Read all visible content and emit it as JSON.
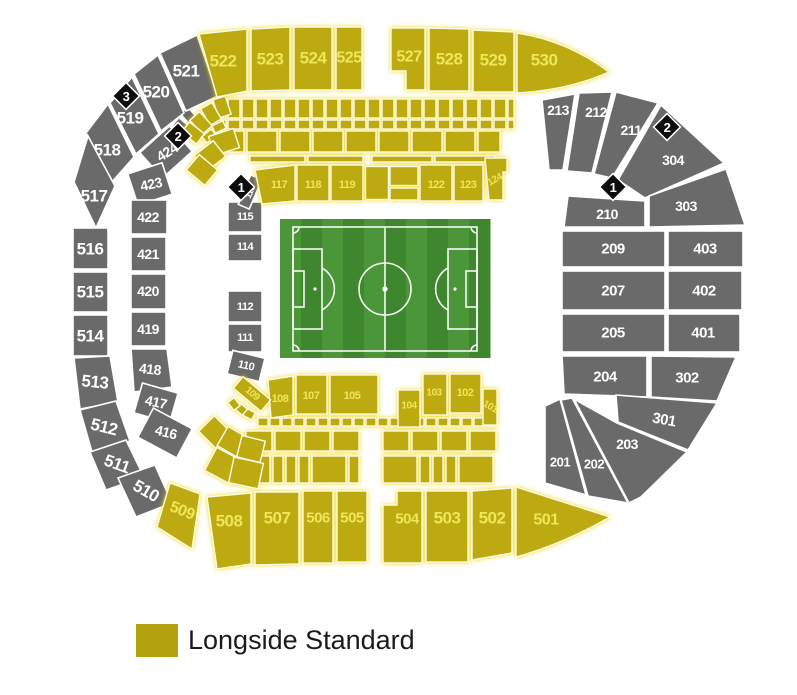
{
  "legend": {
    "label": "Longside Standard",
    "swatch_color": "#B3A20D"
  },
  "colors": {
    "standard_fill": "#BCAA10",
    "standard_text": "#EFE65A",
    "unavailable_fill": "#6A6A6A",
    "unavailable_text": "#FFFFFF",
    "landmark_fill": "#0D0D0D",
    "landmark_text": "#FFFFFF",
    "pitch_stripe_light": "#4A9638",
    "pitch_stripe_dark": "#3F872E",
    "pitch_line": "#FFFFFF",
    "background": "#FFFFFF"
  },
  "landmarks": [
    {
      "label": "3",
      "x": 126,
      "y": 96
    },
    {
      "label": "2",
      "x": 178,
      "y": 136
    },
    {
      "label": "1",
      "x": 241,
      "y": 187
    },
    {
      "label": "2",
      "x": 667,
      "y": 127
    },
    {
      "label": "1",
      "x": 613,
      "y": 187
    }
  ],
  "sections": [
    {
      "id": "522",
      "kind": "standard",
      "shape": "poly",
      "pts": "199,34 247,29 247,91 217,97",
      "lx": 223,
      "ly": 61,
      "fs": 17
    },
    {
      "id": "523",
      "kind": "standard",
      "shape": "poly",
      "pts": "251,29 290,27 290,90 251,91",
      "lx": 270,
      "ly": 59,
      "fs": 17
    },
    {
      "id": "524",
      "kind": "standard",
      "shape": "poly",
      "pts": "294,27 332,27 332,90 294,90",
      "lx": 313,
      "ly": 58,
      "fs": 17
    },
    {
      "id": "525",
      "kind": "standard",
      "shape": "poly",
      "pts": "336,27 362,27 362,90 336,90",
      "lx": 349,
      "ly": 58,
      "fs": 16
    },
    {
      "id": "527",
      "kind": "standard",
      "shape": "poly",
      "pts": "391,28 425,28 425,90 406,90 406,71 391,71",
      "lx": 409,
      "ly": 57,
      "fs": 16
    },
    {
      "id": "528",
      "kind": "standard",
      "shape": "poly",
      "pts": "429,28 469,29 469,91 429,91",
      "lx": 449,
      "ly": 59,
      "fs": 17
    },
    {
      "id": "529",
      "kind": "standard",
      "shape": "poly",
      "pts": "473,30 514,32 514,92 473,92",
      "lx": 493,
      "ly": 60,
      "fs": 17
    },
    {
      "id": "530",
      "kind": "standard",
      "shape": "path",
      "d": "M517,33 C552,38 584,53 609,72 C578,86 547,91 517,93 Z",
      "lx": 544,
      "ly": 60,
      "fs": 17
    },
    {
      "id": "509",
      "kind": "standard",
      "shape": "poly",
      "pts": "170,483 200,494 192,549 157,527",
      "lx": 182,
      "ly": 511,
      "fs": 16,
      "lr": 22
    },
    {
      "id": "508",
      "kind": "standard",
      "shape": "poly",
      "pts": "207,497 251,493 251,564 217,569",
      "lx": 229,
      "ly": 521,
      "fs": 17
    },
    {
      "id": "507",
      "kind": "standard",
      "shape": "poly",
      "pts": "255,492 299,492 299,564 255,565",
      "lx": 277,
      "ly": 518,
      "fs": 17
    },
    {
      "id": "506",
      "kind": "standard",
      "shape": "rect",
      "x": 303,
      "y": 491,
      "w": 30,
      "h": 72,
      "lx": 318,
      "ly": 518,
      "fs": 15
    },
    {
      "id": "505",
      "kind": "standard",
      "shape": "rect",
      "x": 337,
      "y": 491,
      "w": 30,
      "h": 71,
      "lx": 352,
      "ly": 518,
      "fs": 15
    },
    {
      "id": "504",
      "kind": "standard",
      "shape": "poly",
      "pts": "383,505 397,505 397,491 422,491 422,563 383,563",
      "lx": 407,
      "ly": 519,
      "fs": 15
    },
    {
      "id": "503",
      "kind": "standard",
      "shape": "rect",
      "x": 426,
      "y": 491,
      "w": 42,
      "h": 71,
      "lx": 447,
      "ly": 518,
      "fs": 17
    },
    {
      "id": "502",
      "kind": "standard",
      "shape": "poly",
      "pts": "472,491 512,488 512,553 472,560",
      "lx": 492,
      "ly": 518,
      "fs": 17
    },
    {
      "id": "501",
      "kind": "standard",
      "shape": "path",
      "d": "M516,487 L610,517 Q563,544 516,557 Z",
      "lx": 546,
      "ly": 520,
      "fs": 16
    },
    {
      "id": "117",
      "kind": "standard",
      "shape": "poly",
      "pts": "255,170 295,165 295,201 262,204",
      "lx": 279,
      "ly": 185,
      "fs": 11
    },
    {
      "id": "118",
      "kind": "standard",
      "shape": "rect",
      "x": 297,
      "y": 165,
      "w": 32,
      "h": 36,
      "lx": 313,
      "ly": 185,
      "fs": 11
    },
    {
      "id": "119",
      "kind": "standard",
      "shape": "rect",
      "x": 331,
      "y": 165,
      "w": 32,
      "h": 36,
      "lx": 347,
      "ly": 185,
      "fs": 11
    },
    {
      "id": "122",
      "kind": "standard",
      "shape": "rect",
      "x": 420,
      "y": 165,
      "w": 32,
      "h": 36,
      "lx": 436,
      "ly": 185,
      "fs": 11
    },
    {
      "id": "123",
      "kind": "standard",
      "shape": "rect",
      "x": 454,
      "y": 165,
      "w": 29,
      "h": 36,
      "lx": 468,
      "ly": 185,
      "fs": 11
    },
    {
      "id": "124",
      "kind": "standard",
      "shape": "poly",
      "pts": "485,158 507,158 507,172 503,172 503,200 489,200",
      "lx": 495,
      "ly": 180,
      "fs": 10,
      "lr": -30
    },
    {
      "id": "108",
      "kind": "standard",
      "shape": "poly",
      "pts": "268,380 293,376 293,415 271,418",
      "lx": 280,
      "ly": 399,
      "fs": 11
    },
    {
      "id": "107",
      "kind": "standard",
      "shape": "rect",
      "x": 296,
      "y": 375,
      "w": 31,
      "h": 39,
      "lx": 311,
      "ly": 396,
      "fs": 11
    },
    {
      "id": "105",
      "kind": "standard",
      "shape": "rect",
      "x": 330,
      "y": 375,
      "w": 48,
      "h": 39,
      "lx": 352,
      "ly": 396,
      "fs": 11
    },
    {
      "id": "104",
      "kind": "standard",
      "shape": "rect",
      "x": 398,
      "y": 390,
      "w": 22,
      "h": 37,
      "lx": 409,
      "ly": 406,
      "fs": 10
    },
    {
      "id": "103",
      "kind": "standard",
      "shape": "rect",
      "x": 423,
      "y": 374,
      "w": 24,
      "h": 41,
      "lx": 434,
      "ly": 393,
      "fs": 10
    },
    {
      "id": "102",
      "kind": "standard",
      "shape": "rect",
      "x": 450,
      "y": 374,
      "w": 31,
      "h": 39,
      "lx": 465,
      "ly": 393,
      "fs": 11
    },
    {
      "id": "101",
      "kind": "standard",
      "shape": "rect",
      "x": 483,
      "y": 389,
      "w": 14,
      "h": 36,
      "lx": 490,
      "ly": 407,
      "fs": 10,
      "lr": 30
    },
    {
      "id": "109",
      "kind": "standard",
      "shape": "rrect",
      "cx": 252,
      "cy": 394,
      "w": 36,
      "h": 15,
      "rot": 40,
      "lx": 252,
      "ly": 394,
      "fs": 10,
      "lr": 40
    },
    {
      "id": "521",
      "kind": "gray",
      "shape": "poly",
      "pts": "160,53 197,35 218,96 186,111",
      "lx": 186,
      "ly": 71,
      "fs": 17
    },
    {
      "id": "520",
      "kind": "gray",
      "shape": "poly",
      "pts": "134,74 158,55 184,113 161,131",
      "lx": 156,
      "ly": 92,
      "fs": 17
    },
    {
      "id": "519",
      "kind": "gray",
      "shape": "poly",
      "pts": "110,103 132,77 159,134 136,154",
      "lx": 130,
      "ly": 118,
      "fs": 17
    },
    {
      "id": "518",
      "kind": "gray",
      "shape": "poly",
      "pts": "86,133 108,104 134,157 111,183",
      "lx": 107,
      "ly": 150,
      "fs": 17
    },
    {
      "id": "517",
      "kind": "gray",
      "shape": "poly",
      "pts": "74,182 88,136 115,186 96,228",
      "lx": 94,
      "ly": 196,
      "fs": 17
    },
    {
      "id": "516",
      "kind": "gray",
      "shape": "rect",
      "x": 73,
      "y": 228,
      "w": 35,
      "h": 41,
      "lx": 90,
      "ly": 249,
      "fs": 17
    },
    {
      "id": "515",
      "kind": "gray",
      "shape": "rect",
      "x": 73,
      "y": 272,
      "w": 35,
      "h": 40,
      "lx": 90,
      "ly": 292,
      "fs": 17
    },
    {
      "id": "514",
      "kind": "gray",
      "shape": "rect",
      "x": 73,
      "y": 315,
      "w": 35,
      "h": 41,
      "lx": 90,
      "ly": 336,
      "fs": 17
    },
    {
      "id": "513",
      "kind": "gray",
      "shape": "poly",
      "pts": "74,358 110,356 118,402 80,409",
      "lx": 95,
      "ly": 382,
      "fs": 17,
      "lr": 6
    },
    {
      "id": "512",
      "kind": "gray",
      "shape": "poly",
      "pts": "80,410 116,401 130,441 92,452",
      "lx": 104,
      "ly": 427,
      "fs": 17,
      "lr": 14
    },
    {
      "id": "511",
      "kind": "gray",
      "shape": "poly",
      "pts": "90,452 126,440 144,477 106,490",
      "lx": 117,
      "ly": 464,
      "fs": 17,
      "lr": 20
    },
    {
      "id": "510",
      "kind": "gray",
      "shape": "poly",
      "pts": "118,478 155,465 172,503 136,517",
      "lx": 146,
      "ly": 491,
      "fs": 17,
      "lr": 30
    },
    {
      "id": "424",
      "kind": "gray",
      "shape": "rrect",
      "cx": 166,
      "cy": 152,
      "w": 40,
      "h": 34,
      "rot": -42,
      "lx": 167,
      "ly": 152,
      "fs": 14,
      "lr": -32
    },
    {
      "id": "423",
      "kind": "gray",
      "shape": "rrect",
      "cx": 150,
      "cy": 184,
      "w": 36,
      "h": 33,
      "rot": -18,
      "lx": 151,
      "ly": 184,
      "fs": 14,
      "lr": -12
    },
    {
      "id": "422",
      "kind": "gray",
      "shape": "rect",
      "x": 131,
      "y": 200,
      "w": 36,
      "h": 34,
      "lx": 148,
      "ly": 217,
      "fs": 14
    },
    {
      "id": "421",
      "kind": "gray",
      "shape": "rect",
      "x": 131,
      "y": 237,
      "w": 35,
      "h": 34,
      "lx": 148,
      "ly": 254,
      "fs": 14
    },
    {
      "id": "420",
      "kind": "gray",
      "shape": "rect",
      "x": 131,
      "y": 274,
      "w": 35,
      "h": 35,
      "lx": 148,
      "ly": 291,
      "fs": 14
    },
    {
      "id": "419",
      "kind": "gray",
      "shape": "rect",
      "x": 131,
      "y": 312,
      "w": 35,
      "h": 34,
      "lx": 148,
      "ly": 329,
      "fs": 14
    },
    {
      "id": "418",
      "kind": "gray",
      "shape": "poly",
      "pts": "131,349 167,349 172,387 134,392",
      "lx": 150,
      "ly": 369,
      "fs": 14,
      "lr": 6
    },
    {
      "id": "417",
      "kind": "gray",
      "shape": "rrect",
      "cx": 156,
      "cy": 403,
      "w": 37,
      "h": 31,
      "rot": 16,
      "lx": 156,
      "ly": 402,
      "fs": 14,
      "lr": 12
    },
    {
      "id": "416",
      "kind": "gray",
      "shape": "rrect",
      "cx": 165,
      "cy": 433,
      "w": 44,
      "h": 33,
      "rot": 28,
      "lx": 166,
      "ly": 432,
      "fs": 14,
      "lr": 14
    },
    {
      "id": "115",
      "kind": "gray",
      "shape": "rect",
      "x": 228,
      "y": 202,
      "w": 34,
      "h": 30,
      "lx": 245,
      "ly": 217,
      "fs": 11
    },
    {
      "id": "114",
      "kind": "gray",
      "shape": "rect",
      "x": 228,
      "y": 234,
      "w": 34,
      "h": 27,
      "lx": 245,
      "ly": 247,
      "fs": 11
    },
    {
      "id": "112",
      "kind": "gray",
      "shape": "rect",
      "x": 228,
      "y": 291,
      "w": 34,
      "h": 31,
      "lx": 245,
      "ly": 307,
      "fs": 11
    },
    {
      "id": "111",
      "kind": "gray",
      "shape": "rect",
      "x": 228,
      "y": 324,
      "w": 34,
      "h": 28,
      "lx": 245,
      "ly": 338,
      "fs": 11
    },
    {
      "id": "110",
      "kind": "gray",
      "shape": "rrect",
      "cx": 246,
      "cy": 366,
      "w": 33,
      "h": 24,
      "rot": 14,
      "lx": 246,
      "ly": 366,
      "fs": 11,
      "lr": 12
    },
    {
      "id": "116",
      "kind": "gray",
      "shape": "rrect",
      "cx": 250,
      "cy": 192,
      "w": 12,
      "h": 32,
      "rot": 23,
      "lx": 250,
      "ly": 192,
      "fs": 9,
      "lr": -67
    },
    {
      "id": "213",
      "kind": "gray",
      "shape": "poly",
      "pts": "542,100 575,94 563,170 549,170",
      "lx": 558,
      "ly": 110,
      "fs": 14
    },
    {
      "id": "212",
      "kind": "gray",
      "shape": "poly",
      "pts": "579,93 612,92 592,173 567,171",
      "lx": 596,
      "ly": 112,
      "fs": 14
    },
    {
      "id": "211",
      "kind": "gray",
      "shape": "poly",
      "pts": "616,92 658,103 612,178 594,174",
      "lx": 631,
      "ly": 130,
      "fs": 14
    },
    {
      "id": "304",
      "kind": "gray",
      "shape": "poly",
      "pts": "661,105 724,163 645,198 618,180",
      "lx": 673,
      "ly": 160,
      "fs": 14
    },
    {
      "id": "210",
      "kind": "gray",
      "shape": "poly",
      "pts": "568,196 645,201 645,227 564,227",
      "lx": 607,
      "ly": 214,
      "fs": 14
    },
    {
      "id": "303",
      "kind": "gray",
      "shape": "poly",
      "pts": "649,196 726,169 745,225 649,227",
      "lx": 686,
      "ly": 206,
      "fs": 14
    },
    {
      "id": "209",
      "kind": "gray",
      "shape": "rect",
      "x": 562,
      "y": 231,
      "w": 103,
      "h": 36,
      "lx": 613,
      "ly": 249,
      "fs": 15
    },
    {
      "id": "403",
      "kind": "gray",
      "shape": "rect",
      "x": 668,
      "y": 231,
      "w": 75,
      "h": 36,
      "lx": 705,
      "ly": 249,
      "fs": 15
    },
    {
      "id": "207",
      "kind": "gray",
      "shape": "rect",
      "x": 562,
      "y": 271,
      "w": 103,
      "h": 39,
      "lx": 613,
      "ly": 291,
      "fs": 15
    },
    {
      "id": "402",
      "kind": "gray",
      "shape": "rect",
      "x": 668,
      "y": 271,
      "w": 74,
      "h": 39,
      "lx": 704,
      "ly": 291,
      "fs": 15
    },
    {
      "id": "205",
      "kind": "gray",
      "shape": "rect",
      "x": 562,
      "y": 314,
      "w": 103,
      "h": 38,
      "lx": 613,
      "ly": 333,
      "fs": 15
    },
    {
      "id": "401",
      "kind": "gray",
      "shape": "rect",
      "x": 668,
      "y": 314,
      "w": 72,
      "h": 38,
      "lx": 703,
      "ly": 333,
      "fs": 15
    },
    {
      "id": "204",
      "kind": "gray",
      "shape": "poly",
      "pts": "562,356 647,356 647,397 564,394",
      "lx": 605,
      "ly": 377,
      "fs": 15
    },
    {
      "id": "302",
      "kind": "gray",
      "shape": "poly",
      "pts": "651,356 736,357 717,401 651,397",
      "lx": 687,
      "ly": 378,
      "fs": 15
    },
    {
      "id": "301",
      "kind": "gray",
      "shape": "poly",
      "pts": "616,395 717,403 688,450 618,422",
      "lx": 664,
      "ly": 420,
      "fs": 15,
      "lr": 10
    },
    {
      "id": "203",
      "kind": "gray",
      "shape": "poly",
      "pts": "574,399 617,423 687,452 641,497 629,503",
      "lx": 627,
      "ly": 444,
      "fs": 14
    },
    {
      "id": "202",
      "kind": "gray",
      "shape": "poly",
      "pts": "561,400 572,398 628,503 588,496",
      "lx": 594,
      "ly": 464,
      "fs": 13
    },
    {
      "id": "201",
      "kind": "gray",
      "shape": "poly",
      "pts": "545,406 560,399 586,495 545,483",
      "lx": 560,
      "ly": 462,
      "fs": 13
    }
  ]
}
